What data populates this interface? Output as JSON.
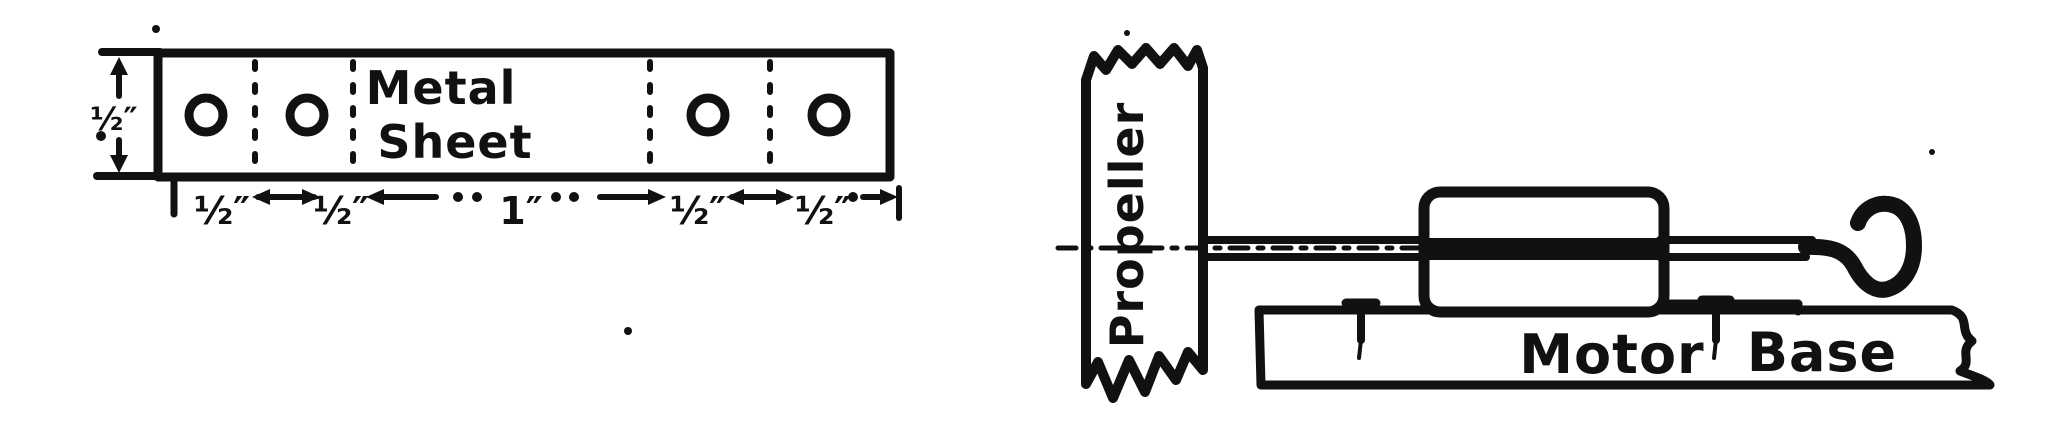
{
  "canvas": {
    "background": "#ffffff",
    "ink": "#111111"
  },
  "metal_sheet_figure": {
    "title_line1": "Metal",
    "title_line2": "Sheet",
    "width_dim": "½″",
    "dim_labels": [
      "½″",
      "½″",
      "1″",
      "½″",
      "½″"
    ],
    "hole_count": 4,
    "bend_line_count": 4
  },
  "motor_figure": {
    "propeller_label": "Propeller",
    "base_word1": "Motor",
    "base_word2": "Base"
  }
}
